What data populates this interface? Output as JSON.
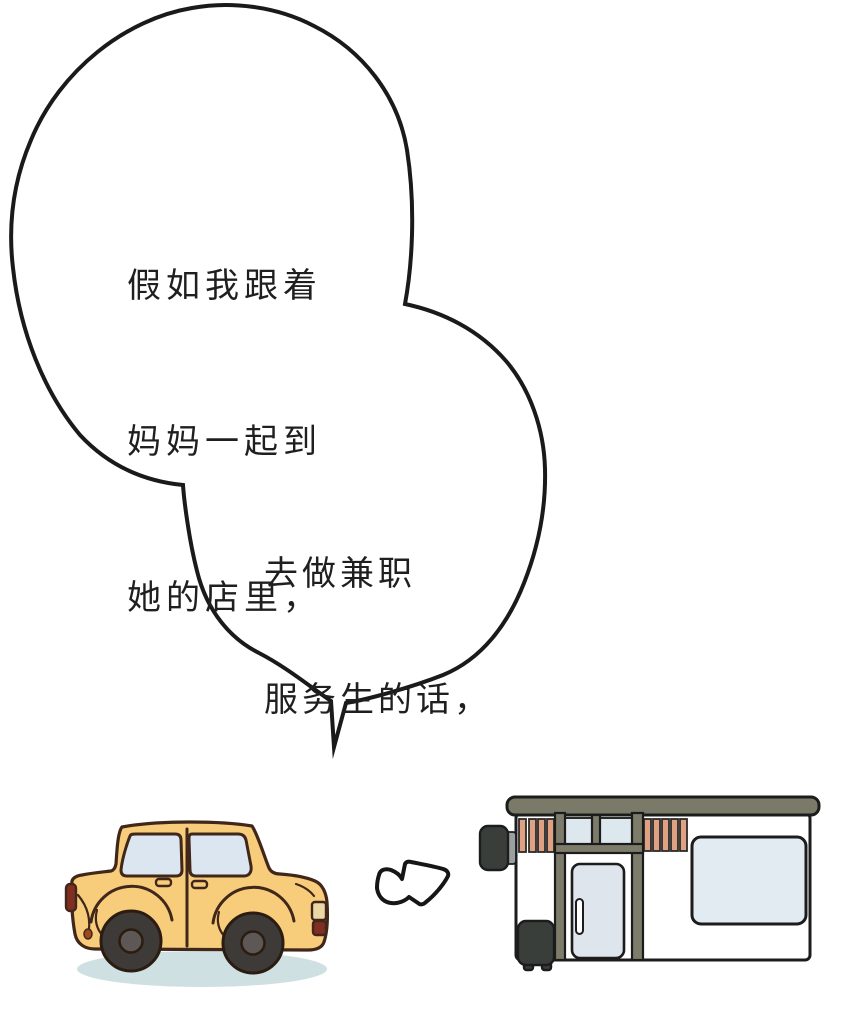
{
  "panel": {
    "type": "comic-panel",
    "background_color": "#ffffff"
  },
  "speech_bubble": {
    "fill_color": "#ffffff",
    "outline_color": "#1a1a1a",
    "text_color": "#1f1f1f",
    "text_block_1": {
      "lines": [
        "假如我跟着",
        "妈妈一起到",
        "她的店里，"
      ]
    },
    "text_block_2": {
      "lines": [
        "去做兼职",
        "服务生的话，"
      ]
    }
  },
  "illustrations": {
    "car": {
      "label": "yellow-cartoon-car",
      "body_color": "#f7cd7c",
      "outline_color": "#41261a",
      "window_color": "#dbe6f0",
      "tire_color": "#3e3a37",
      "hub_color": "#5d5755",
      "taillight_color": "#7f2e21",
      "headlight_color": "#ead7a6",
      "shadow_color": "#cfe0e2"
    },
    "arrow": {
      "label": "right-arrow",
      "fill_color": "#ffffff",
      "outline_color": "#161616"
    },
    "store": {
      "label": "storefront-building",
      "wall_color": "#ffffff",
      "roof_color": "#7b7a69",
      "frame_color": "#7d7c6a",
      "awning_stripe_color": "#e0a182",
      "window_color": "#e3ebf2",
      "door_glass_color": "#dfe5ed",
      "sign_color": "#3a3e3a",
      "bracket_color": "#9aa0a0",
      "outline_color": "#1c1c1c"
    }
  }
}
